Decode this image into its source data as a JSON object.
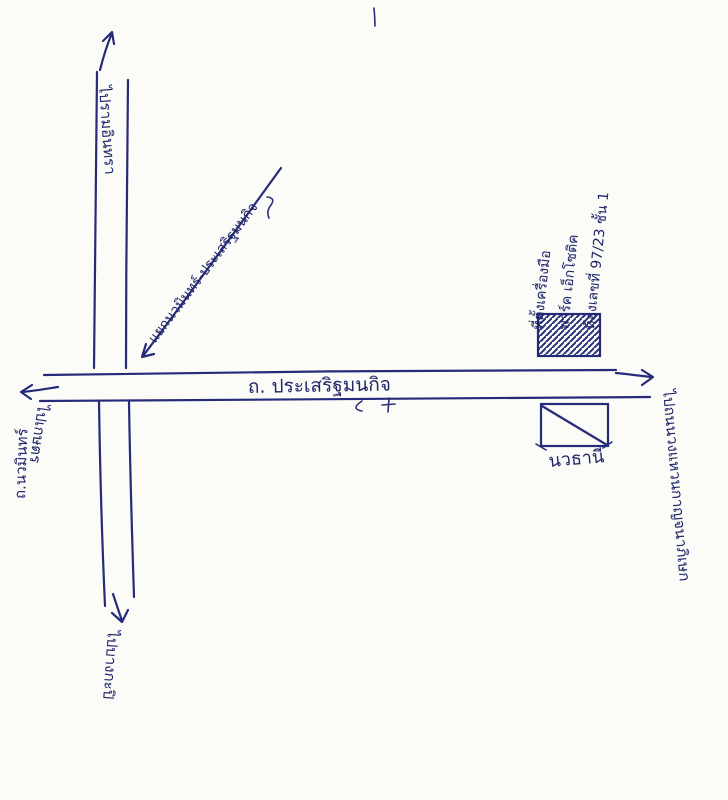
{
  "map": {
    "ink_color": "#252b78",
    "paper_color": "#fbfbf8",
    "roads": {
      "horizontal_label": "ถ. ประเสริฐมนกิจ",
      "vertical_label": "ถ.นวมินทร์",
      "junction_label": "แยกนวมินทร์-ประเสริฐมนกิจ"
    },
    "destinations": {
      "north": "ไปรามอินทรา",
      "south": "ไปบางกะปิ",
      "west": "ไปเกษตร",
      "east": "ไปถนนวงแหวนกาญจนาภิเษก"
    },
    "site_note": {
      "line1": "ที่ตั้งเครื่องมือ",
      "line2": "พาร์ค เอ็กโซติค",
      "line3": "ห้องเลขที่ 97/23 ชั้น 1"
    },
    "landmark_label": "นวธานี"
  }
}
